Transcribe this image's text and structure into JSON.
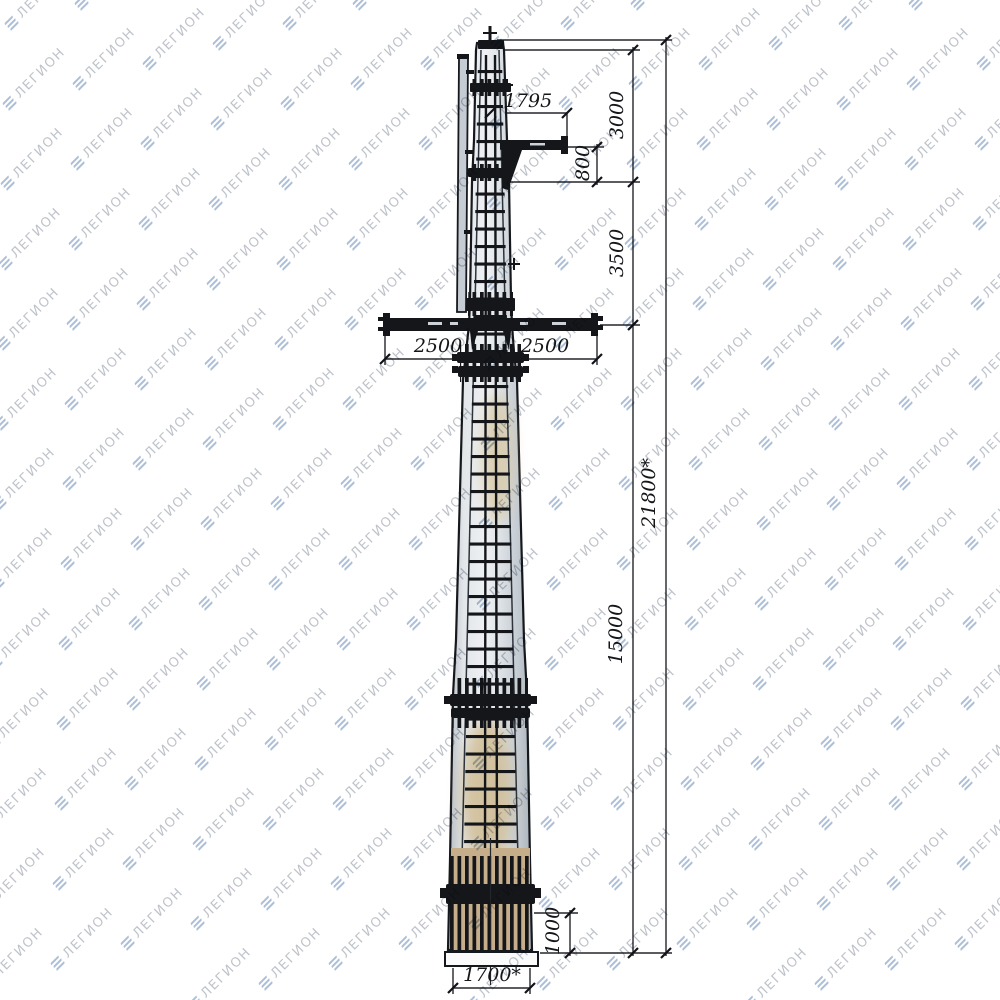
{
  "page": {
    "background": "#ffffff"
  },
  "watermark": {
    "text": "ЛЕГИОН",
    "icon": "layers-icon",
    "text_color": "#b7bcc4",
    "icon_color": "#a3b8d2"
  },
  "drawing": {
    "subject": "steel-transmission-pole-elevation",
    "line_color": "#1a1d21",
    "pole_fill": "#dde1e6",
    "rust_tint": "#cdb astray",
    "base_tint": "#c7ae8a",
    "dimensions": {
      "d1795": "1795",
      "d3000": "3000",
      "d800": "800",
      "d3500": "3500",
      "d2500_left": "2500",
      "d2500_right": "2500",
      "d21800_total": "21800*",
      "d15000": "15000",
      "d1000": "1000",
      "d1700_base": "1700*"
    }
  }
}
